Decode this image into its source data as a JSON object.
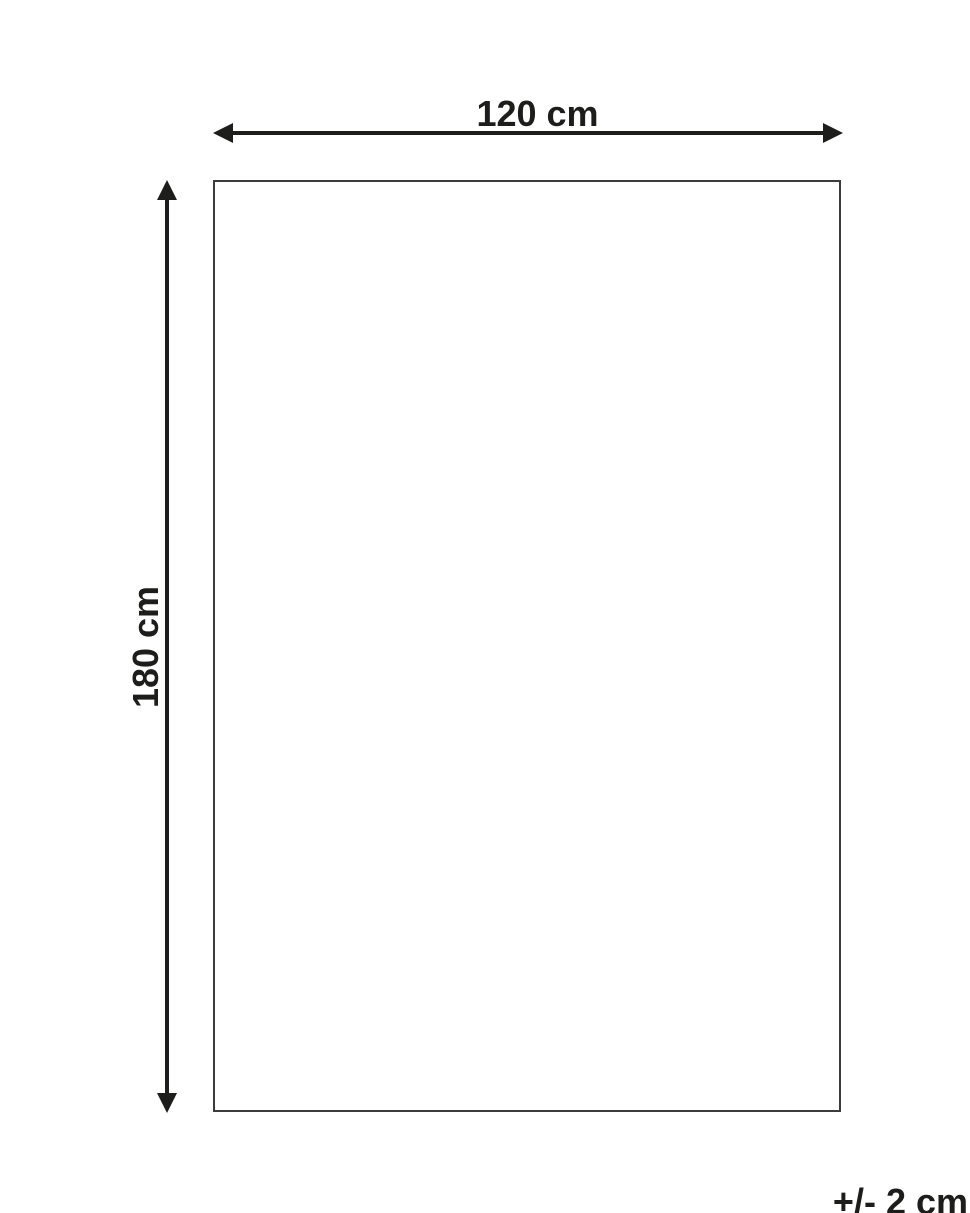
{
  "diagram": {
    "title": "product-dimension-diagram",
    "width_label": "120 cm",
    "height_label": "180 cm",
    "tolerance_label": "+/- 2 cm",
    "dimensions": {
      "width_cm": 120,
      "height_cm": 180,
      "tolerance_cm": 2
    },
    "colors": {
      "arrow": "#1d1d1b",
      "outline": "#3c3c3b",
      "background": "#ffffff"
    }
  }
}
